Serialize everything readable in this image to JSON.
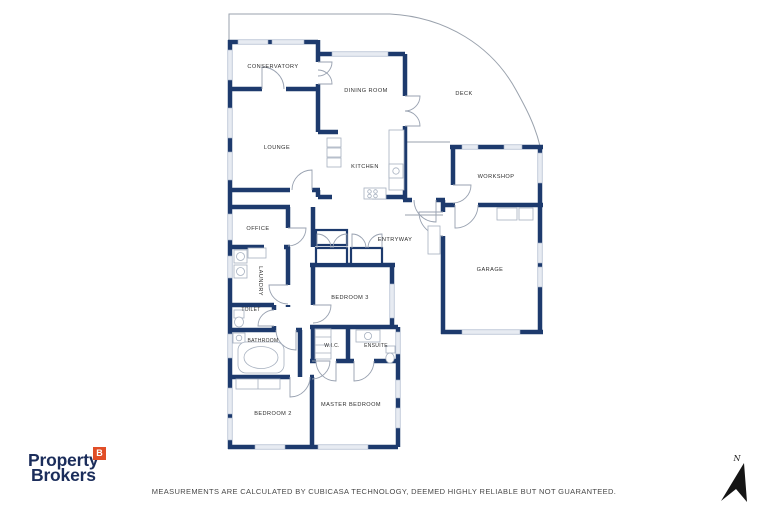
{
  "floorplan": {
    "rooms": [
      {
        "id": "conservatory",
        "label": "CONSERVATORY"
      },
      {
        "id": "dining-room",
        "label": "DINING ROOM"
      },
      {
        "id": "deck",
        "label": "DECK"
      },
      {
        "id": "lounge",
        "label": "LOUNGE"
      },
      {
        "id": "kitchen",
        "label": "KITCHEN"
      },
      {
        "id": "workshop",
        "label": "WORKSHOP"
      },
      {
        "id": "office",
        "label": "OFFICE"
      },
      {
        "id": "entryway",
        "label": "ENTRYWAY"
      },
      {
        "id": "garage",
        "label": "GARAGE"
      },
      {
        "id": "laundry",
        "label": "LAUNDRY"
      },
      {
        "id": "bedroom-3",
        "label": "BEDROOM 3"
      },
      {
        "id": "toilet",
        "label": "TOILET"
      },
      {
        "id": "bathroom",
        "label": "BATHROOM"
      },
      {
        "id": "wic",
        "label": "W.I.C."
      },
      {
        "id": "ensuite",
        "label": "ENSUITE"
      },
      {
        "id": "bedroom-2",
        "label": "BEDROOM 2"
      },
      {
        "id": "master-bedroom",
        "label": "MASTER BEDROOM"
      }
    ],
    "compass_label": "N"
  },
  "branding": {
    "line1": "Property",
    "line2": "Brokers",
    "badge_letter": "B"
  },
  "footer": {
    "disclaimer": "MEASUREMENTS ARE CALCULATED BY CUBICASA TECHNOLOGY, DEEMED HIGHLY RELIABLE BUT NOT GUARANTEED."
  },
  "colors": {
    "wall_navy": "#1d3a6d",
    "logo_navy": "#1b2d5b",
    "badge_orange": "#e14e27",
    "window_fill": "#e7ebf2",
    "door_line": "#98a1b0",
    "deck_line": "#9aa2ad"
  }
}
